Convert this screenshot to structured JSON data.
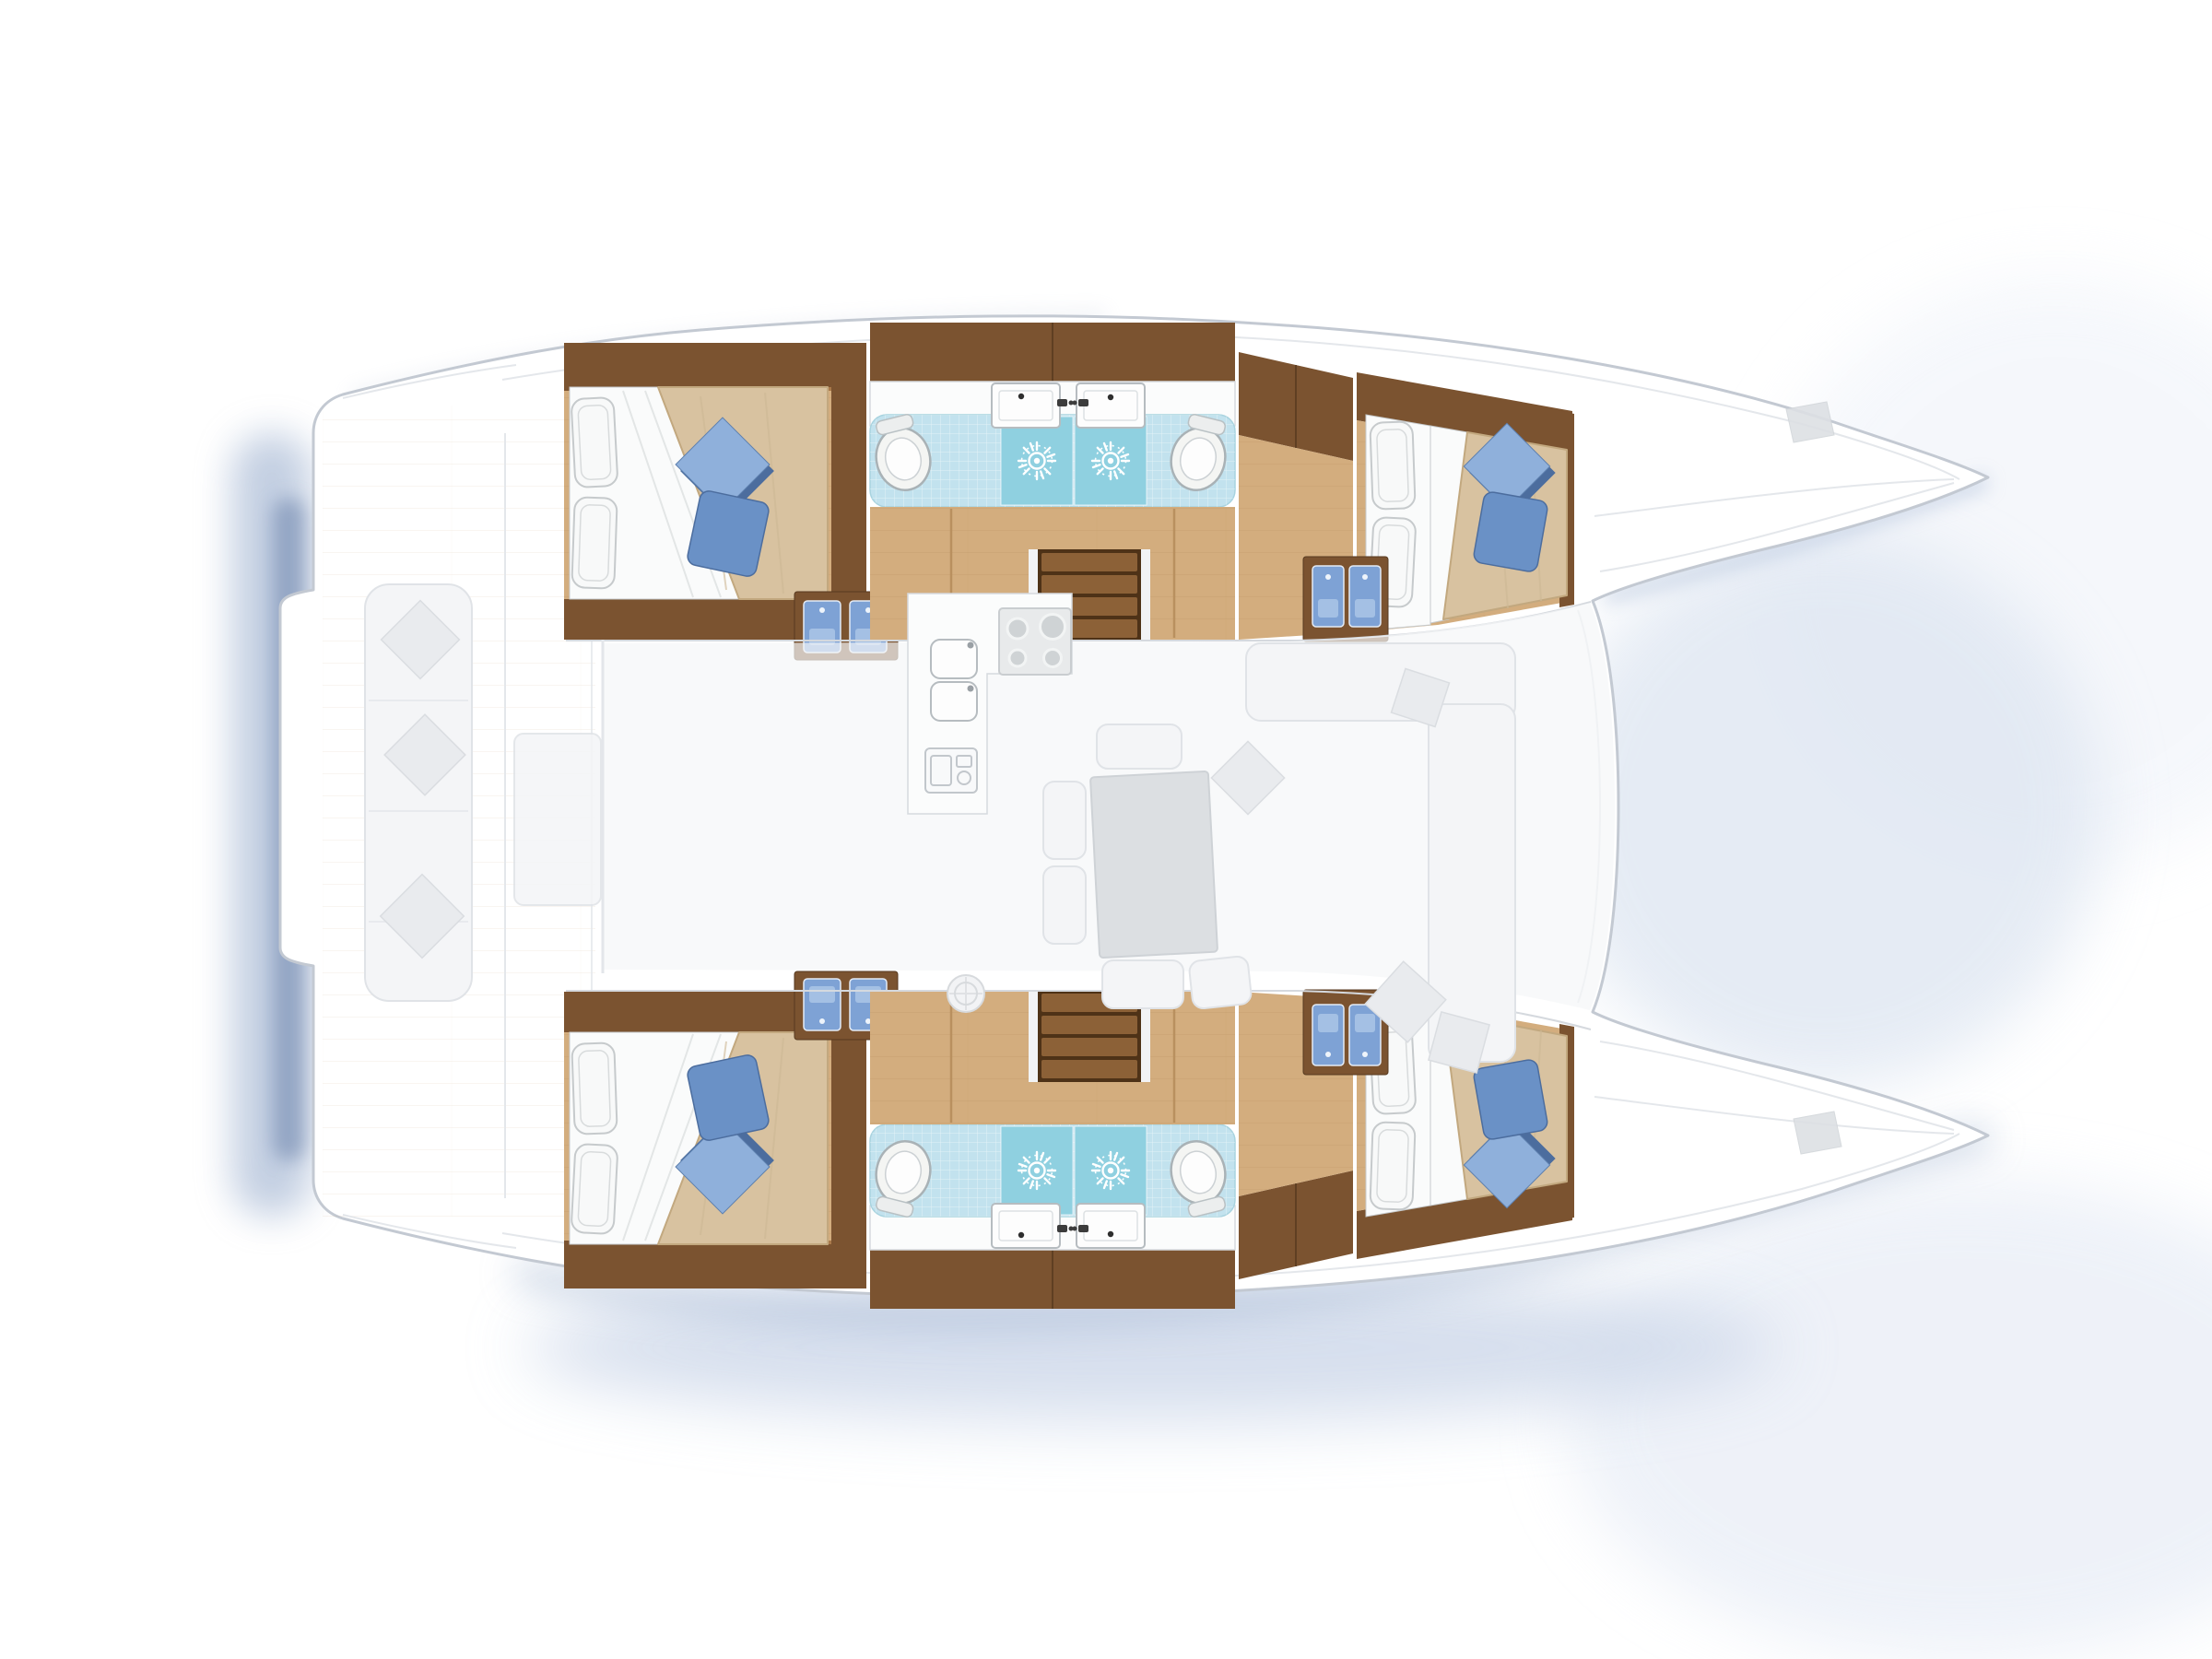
{
  "page": {
    "title": "Catamaran yacht interior floor plan, top view, bows pointing right",
    "drawing_style": "rendered architectural plan with ghosted deck areas"
  },
  "colors": {
    "hull-outline": "#c3c9d2",
    "deck-line": "#e4e7eb",
    "wood-dark": "#7b5330",
    "wood-mid": "#a9794a",
    "wood-floor": "#d3ad7e",
    "wood-step": "#4e3217",
    "wood-step-light": "#8c6137",
    "mattress": "#d8c2a0",
    "sheet-white": "#fafbfb",
    "pillow-stroke": "#c6cacc",
    "blue-pillow": "#6a91c6",
    "blue-pillow-light": "#8fb0db",
    "blue-pillow-dark": "#4c6d9e",
    "tile": "#c2e2ee",
    "shower": "#8fd0e0",
    "porcelain": "#f4f5f3",
    "fixture-stroke": "#a9b2b6",
    "counter": "#fbfcfc",
    "basin-blue": "#7ea2d5",
    "ghost-fill": "#f4f5f7",
    "ghost-stroke": "#e0e3e7",
    "shadow-blue": "#93a8ca",
    "shadow-soft": "#ccd7e9"
  },
  "layout": {
    "hulls": 2,
    "cabins": [
      {
        "name": "port aft double cabin",
        "white_pillows": 2,
        "blue_pillows": 2,
        "private_basins": 2
      },
      {
        "name": "port forward double cabin",
        "white_pillows": 2,
        "blue_pillows": 2,
        "private_basins": 2
      },
      {
        "name": "starboard aft double cabin",
        "white_pillows": 2,
        "blue_pillows": 2,
        "private_basins": 2
      },
      {
        "name": "starboard forward double cabin",
        "white_pillows": 2,
        "blue_pillows": 2,
        "private_basins": 2
      }
    ],
    "bathrooms": [
      {
        "name": "port twin shower rooms",
        "toilets": 2,
        "shower_drains": 2,
        "washbasins": 2,
        "floor": "light blue tile"
      },
      {
        "name": "starboard twin shower rooms",
        "toilets": 2,
        "shower_drains": 2,
        "washbasins": 2,
        "floor": "light blue tile"
      }
    ],
    "salon": {
      "galley": {
        "double_sink": true,
        "stove_burners": 4,
        "appliance_front": 1
      },
      "dinette": {
        "table": 1,
        "seat_cushions": 5,
        "throw_pillows": 4
      },
      "staircases": 2,
      "style": "ghosted light gray"
    },
    "cockpit": {
      "bench": 1,
      "throw_pillows": 3,
      "table": 1,
      "style": "ghosted white"
    },
    "totals": {
      "toilets": 4,
      "shower_drains": 4,
      "bathroom_sinks": 4,
      "cabin_basins": 8,
      "steps_flights": 2
    }
  }
}
